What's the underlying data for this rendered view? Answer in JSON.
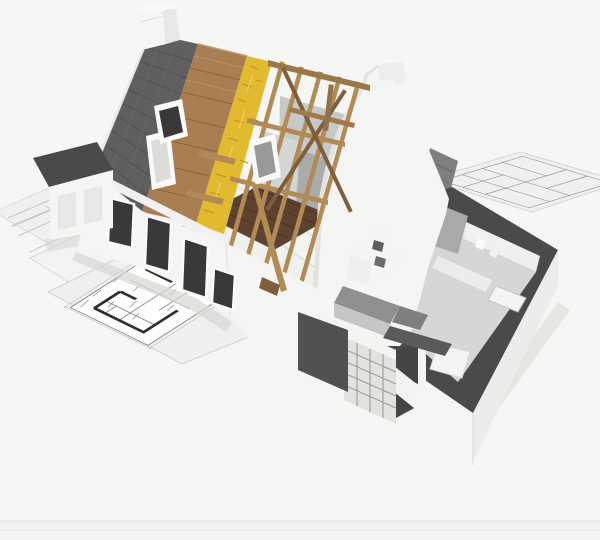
{
  "image": {
    "width": 600,
    "height": 540,
    "kind": "3d-render-house-cutaway-on-blueprints"
  },
  "palette": {
    "background": "#f6f6f4",
    "border_strip": "#ededeb",
    "border_strip2": "#f3f3f1",
    "sheet": "#f0f1ef",
    "sheet_edge": "#d7d8d6",
    "plan_ink": "#7e8387",
    "plan_wall_ink": "#2f2f2f",
    "plan_faint": "#c6c9cb",
    "roof_tile": "#5f5f61",
    "roof_tile_line": "#4f4f51",
    "sheathing": "#a87e52",
    "sheathing_line": "#8a6640",
    "insulation": "#e1ba2f",
    "insulation_dark": "#bf9c1d",
    "rafter_wood": "#b28a56",
    "rafter_dark": "#7d5f3c",
    "beam_wood": "#9a7748",
    "attic_floor": "#5d432f",
    "attic_floor_line": "#4a3523",
    "wall_white": "#f5f5f3",
    "wall_shade": "#e7e7e5",
    "wall_dark_shade": "#d3d3d1",
    "wall_top_dark": "#4a4a4c",
    "grey_plane": "#c7c9c8",
    "grey_plane_light": "#d4d6d5",
    "grey_plane_dark": "#a9abaa",
    "window_opening": "#39393b",
    "window_frame": "#fafaf8",
    "interior_floor": "#d6d6d4",
    "interior_wall": "#efefed",
    "counter_dark": "#8f8f91",
    "counter_step": "#7f7f81",
    "cabinet_grey": "#c6c6c4",
    "block_wall": "#e2e2df",
    "block_joint": "#9c9c98",
    "opening_dark": "#454547",
    "fixture_white": "#f4f4f2",
    "shadow": "#d8d8d6",
    "roof_piece_grey": "#7f7f81"
  }
}
